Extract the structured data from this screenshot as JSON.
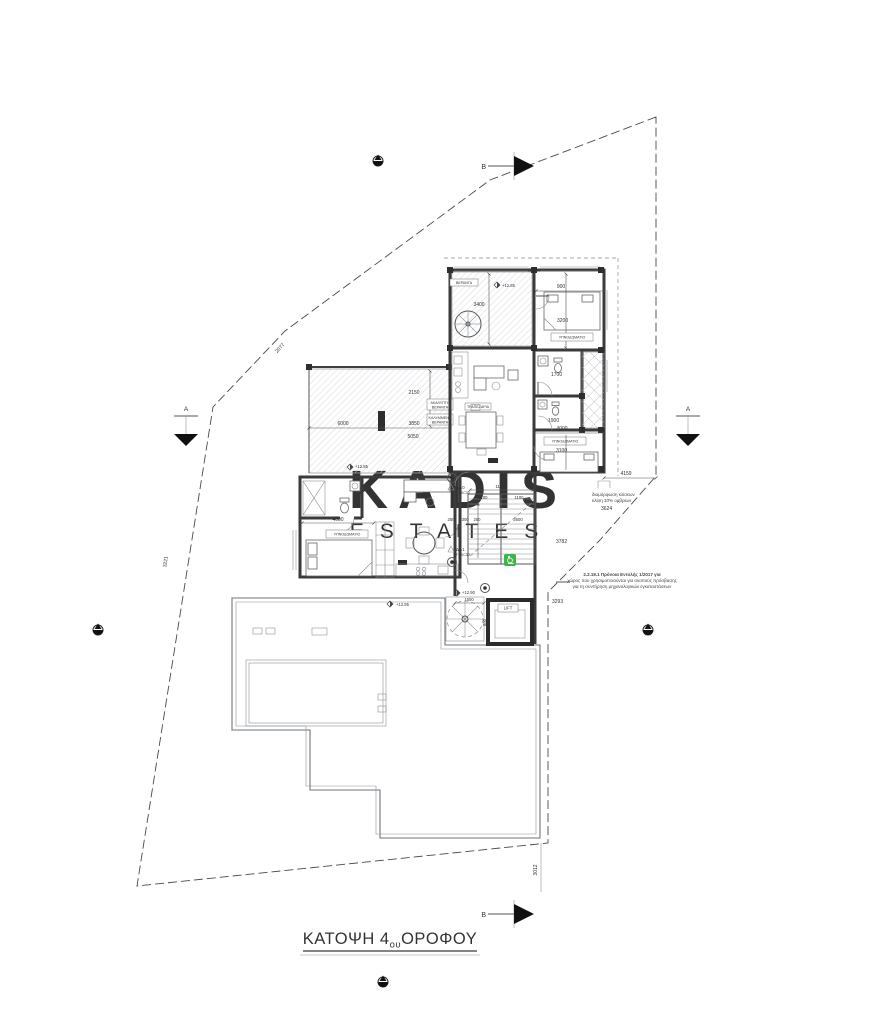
{
  "colors": {
    "wall": "#3a3a3a",
    "line": "#707070",
    "hatch": "#ccd1d6",
    "accent_green": "#3cb54a",
    "watermark": "#dadada"
  },
  "title": {
    "main": "ΚΑΤΟΨΗ 4",
    "sub": "ου",
    "suffix": "ΟΡΟΦΟΥ"
  },
  "watermark": {
    "line1": "KADIS",
    "line2": "ESTATES"
  },
  "section_markers": {
    "a": "A",
    "b": "B"
  },
  "elevations": {
    "upper": "+12.85",
    "veranda": "+12.85",
    "lobby": "+12.90",
    "terrace": "+12.85"
  },
  "labels": {
    "bedroom1": "ΥΠΝΟΔΩΜΑΤΙΟ",
    "bedroom2": "ΥΠΝΟΔΩΜΑΤΙΟ",
    "bedroom3": "ΥΠΝΟΔΩΜΑΤΙΟ",
    "veranda_box": "ΒΕΡΑΝΤΑ",
    "open_veranda_l1": "ΑΚΑΛΥΠΤΗ",
    "open_veranda_l2": "ΒΕΡΑΝΤΑ",
    "covered_veranda_l1": "ΚΑΛΥΜΜΕΝΗ",
    "covered_veranda_l2": "ΒΕΡΑΝΤΑ",
    "dining": "ΤΡΑΠΕΖΑΡΙΑ",
    "lift": "LIFT",
    "door_top": "Δ4.0",
    "door_top2": "FRSC30",
    "door_bottom": "Δ4.1",
    "door_bottom2": "FRSC30"
  },
  "dims": {
    "a3400": "3400",
    "a900": "900",
    "a3200": "3200",
    "a1700": "1700",
    "a1900": "1900",
    "a4000": "4000",
    "a3100": "3100",
    "v2150": "2150",
    "v6000": "6000",
    "v3850": "3850",
    "v5050": "5050",
    "b4000": "4000",
    "s1100a": "1100",
    "s1100b": "1100",
    "s1100c": "1100",
    "s250a": "250",
    "s1300": "1300",
    "s250b": "250",
    "s2600": "2600",
    "s1500": "1500",
    "s800": "800",
    "p2077": "2077",
    "p3221": "3221",
    "p3012": "3012",
    "p3782": "3782",
    "p3293": "3293",
    "p4159": "4159",
    "p3624": "3624"
  },
  "notes": {
    "provision_l1": "2.2.19.1 Πρόνοια Εντολής 1/2017 για",
    "provision_l2": "χώρος που χρησιμοποιούνται για σκοπούς πρόσβασης",
    "provision_l3": "για τη συντήρηση μηχανολογικών εγκαταστάσεων",
    "slope_l1": "διαμόρφωση κλίσεων",
    "slope_l2": "κλίση 10% ομβρίων"
  }
}
